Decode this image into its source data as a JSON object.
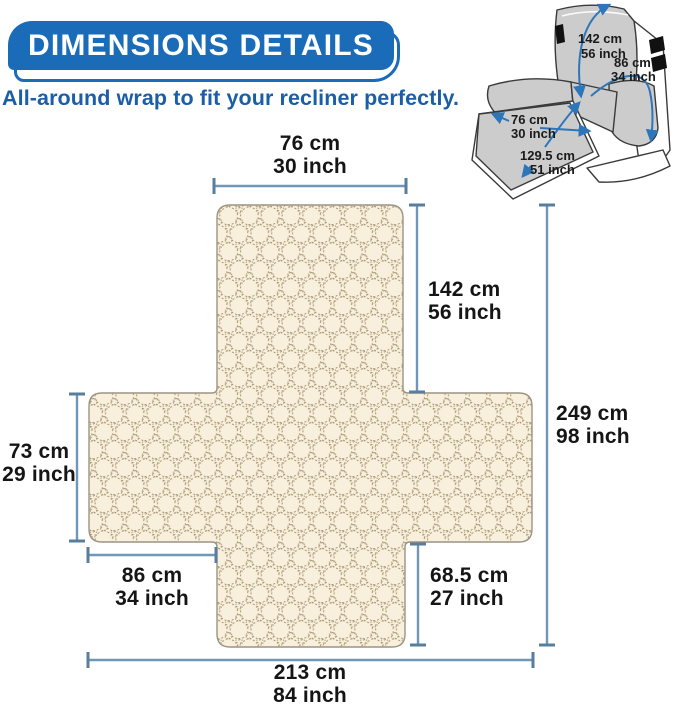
{
  "banner": {
    "title": "DIMENSIONS DETAILS"
  },
  "tagline": "All-around wrap to fit your recliner perfectly.",
  "recliner": {
    "dims": {
      "back_height": {
        "cm": "142 cm",
        "inch": "56 inch"
      },
      "arm_wrap": {
        "cm": "86 cm",
        "inch": "34 inch"
      },
      "footrest_width": {
        "cm": "76 cm",
        "inch": "30 inch"
      },
      "seat_length": {
        "cm": "129.5 cm",
        "inch": "51 inch"
      }
    }
  },
  "cover": {
    "dims": {
      "top_width": {
        "cm": "76 cm",
        "inch": "30 inch"
      },
      "back_panel_height": {
        "cm": "142 cm",
        "inch": "56 inch"
      },
      "total_length": {
        "cm": "249 cm",
        "inch": "98 inch"
      },
      "side_panel_height": {
        "cm": "73 cm",
        "inch": "29 inch"
      },
      "side_panel_width": {
        "cm": "86 cm",
        "inch": "34 inch"
      },
      "front_panel_height": {
        "cm": "68.5 cm",
        "inch": "27 inch"
      },
      "total_width": {
        "cm": "213 cm",
        "inch": "84 inch"
      }
    }
  },
  "colors": {
    "banner_blue": "#1b6cb8",
    "tagline_blue": "#1a5ea8",
    "dim_line_blue": "#7096b8",
    "dim_cap_blue": "#587e9c",
    "arrow_blue": "#2d76ba",
    "fabric_cream": "#f8f0dc",
    "fabric_stitch": "#9a8460",
    "label_black": "#151515",
    "chair_gray": "#cccccc"
  }
}
